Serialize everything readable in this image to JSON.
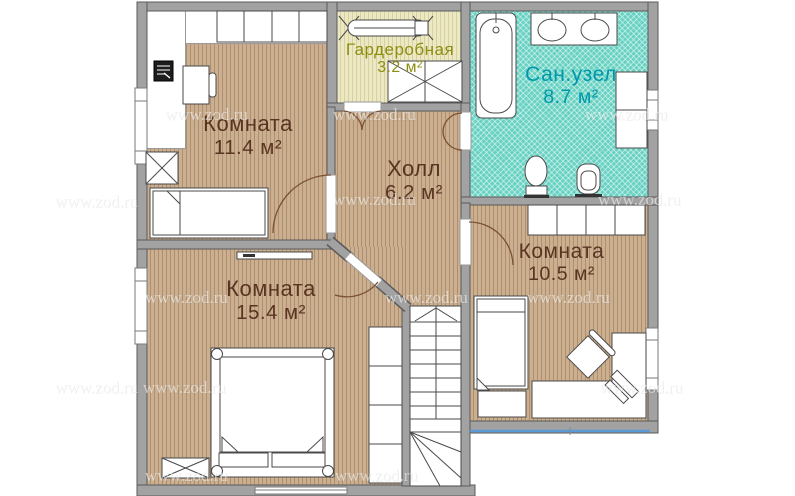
{
  "watermark": {
    "text": "www.zod.ru"
  },
  "plan": {
    "rooms": [
      {
        "key": "room-11-4",
        "label": "Комната",
        "area": "11.4 м²",
        "label_color": "#5a3422"
      },
      {
        "key": "wardrobe",
        "label": "Гардеробная",
        "area": "3.2 м²",
        "label_color": "#8d8d10"
      },
      {
        "key": "bathroom",
        "label": "Сан.узел",
        "area": "8.7 м²",
        "label_color": "#0098aa"
      },
      {
        "key": "hall",
        "label": "Холл",
        "area": "6.2 м²",
        "label_color": "#5a3422"
      },
      {
        "key": "room-15-4",
        "label": "Комната",
        "area": "15.4 м²",
        "label_color": "#5a3422"
      },
      {
        "key": "room-10-5",
        "label": "Комната",
        "area": "10.5 м²",
        "label_color": "#5a3422"
      }
    ],
    "colors": {
      "wall": "#a2a2a2",
      "wall_outline": "#5a5a5a",
      "wood_floor": "#cbaf8e",
      "wardrobe_floor": "#ebe7c3",
      "bath_floor": "#68d2c2",
      "window_accent": "#5b9bd5",
      "room_text": "#5a3422",
      "wardrobe_text": "#8d8d10",
      "bath_text": "#0098aa"
    }
  }
}
